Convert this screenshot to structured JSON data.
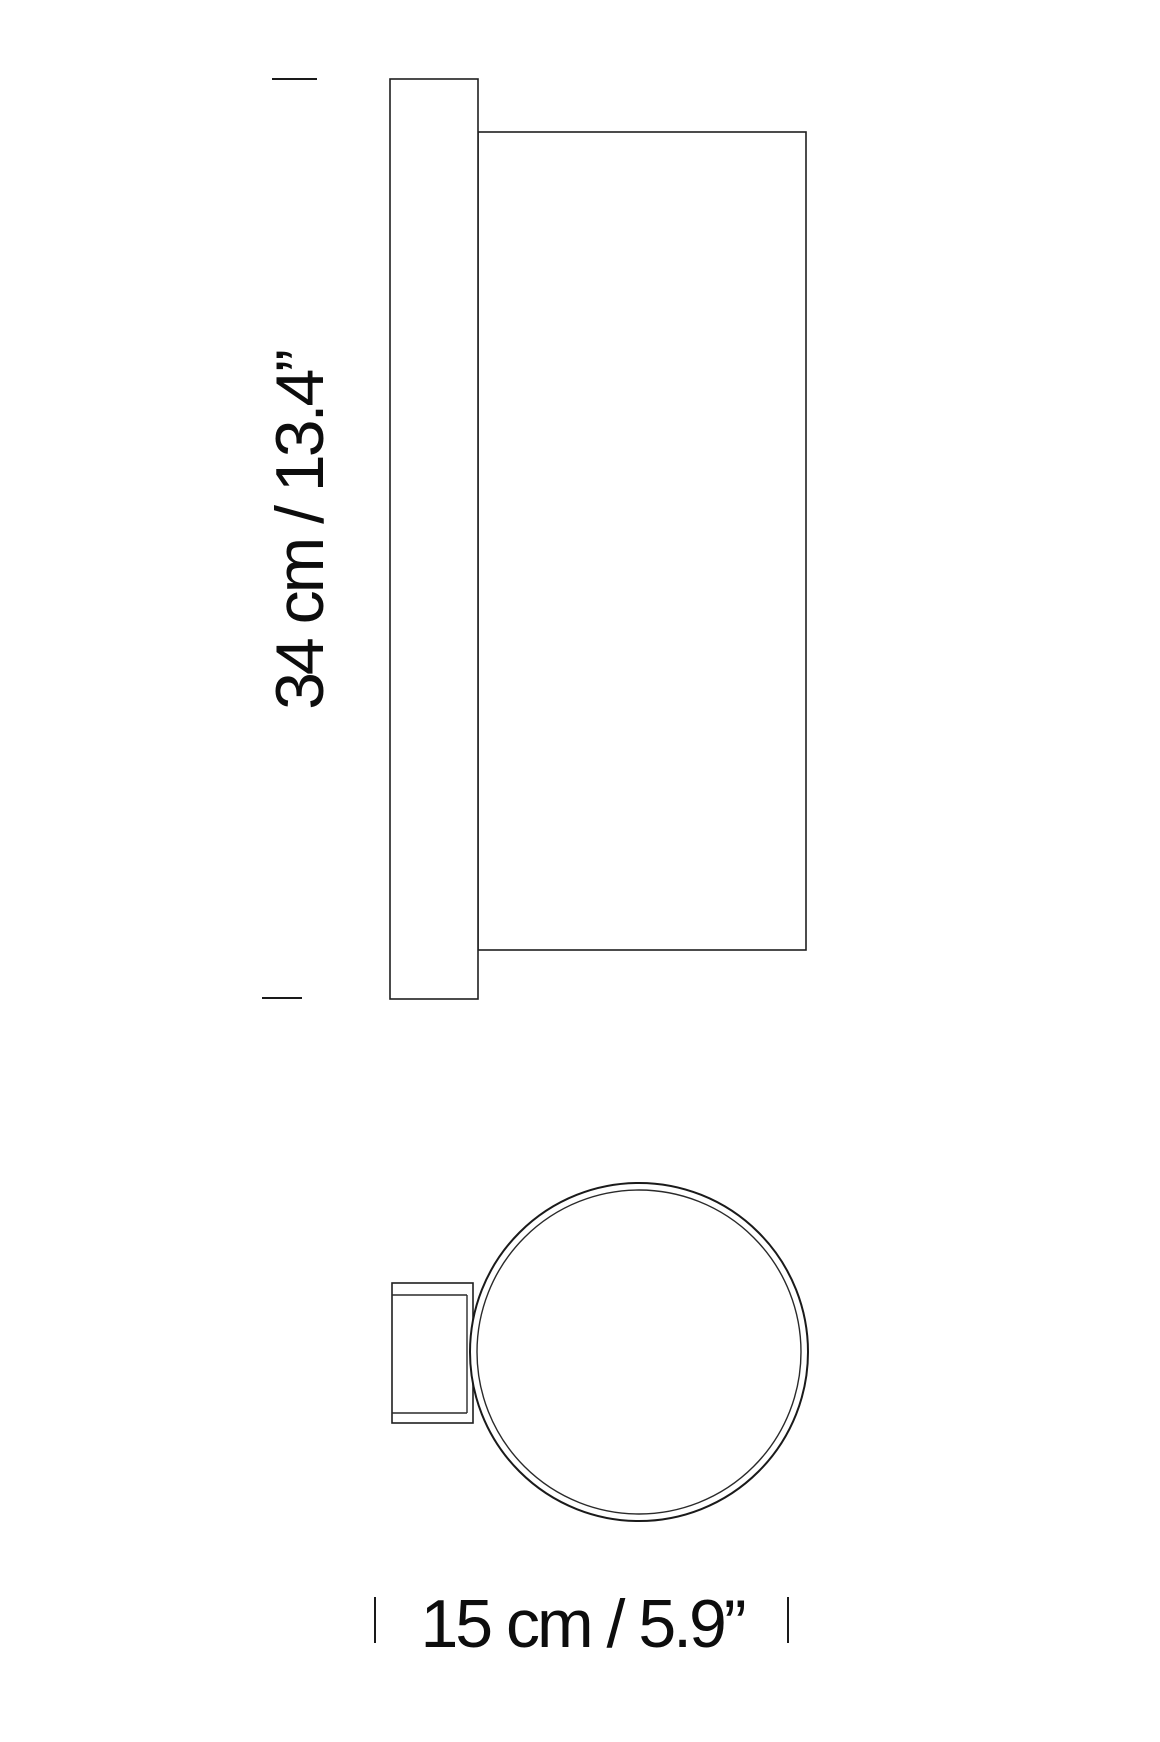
{
  "page": {
    "background_color": "#ffffff",
    "line_color": "#1a1a1a",
    "kind": "lamp dimension drawing"
  },
  "side_view": {
    "description": "side elevation of wall lamp: backplate with cylindrical shade",
    "height_dimension": {
      "label": "34 cm / 13.4”",
      "value_cm": "34 cm",
      "value_in": "13.4”"
    }
  },
  "top_view": {
    "description": "plan view of wall lamp: circular shade with wall bracket",
    "width_dimension": {
      "label": "15 cm / 5.9”",
      "value_cm": "15 cm",
      "value_in": "5.9”"
    }
  }
}
